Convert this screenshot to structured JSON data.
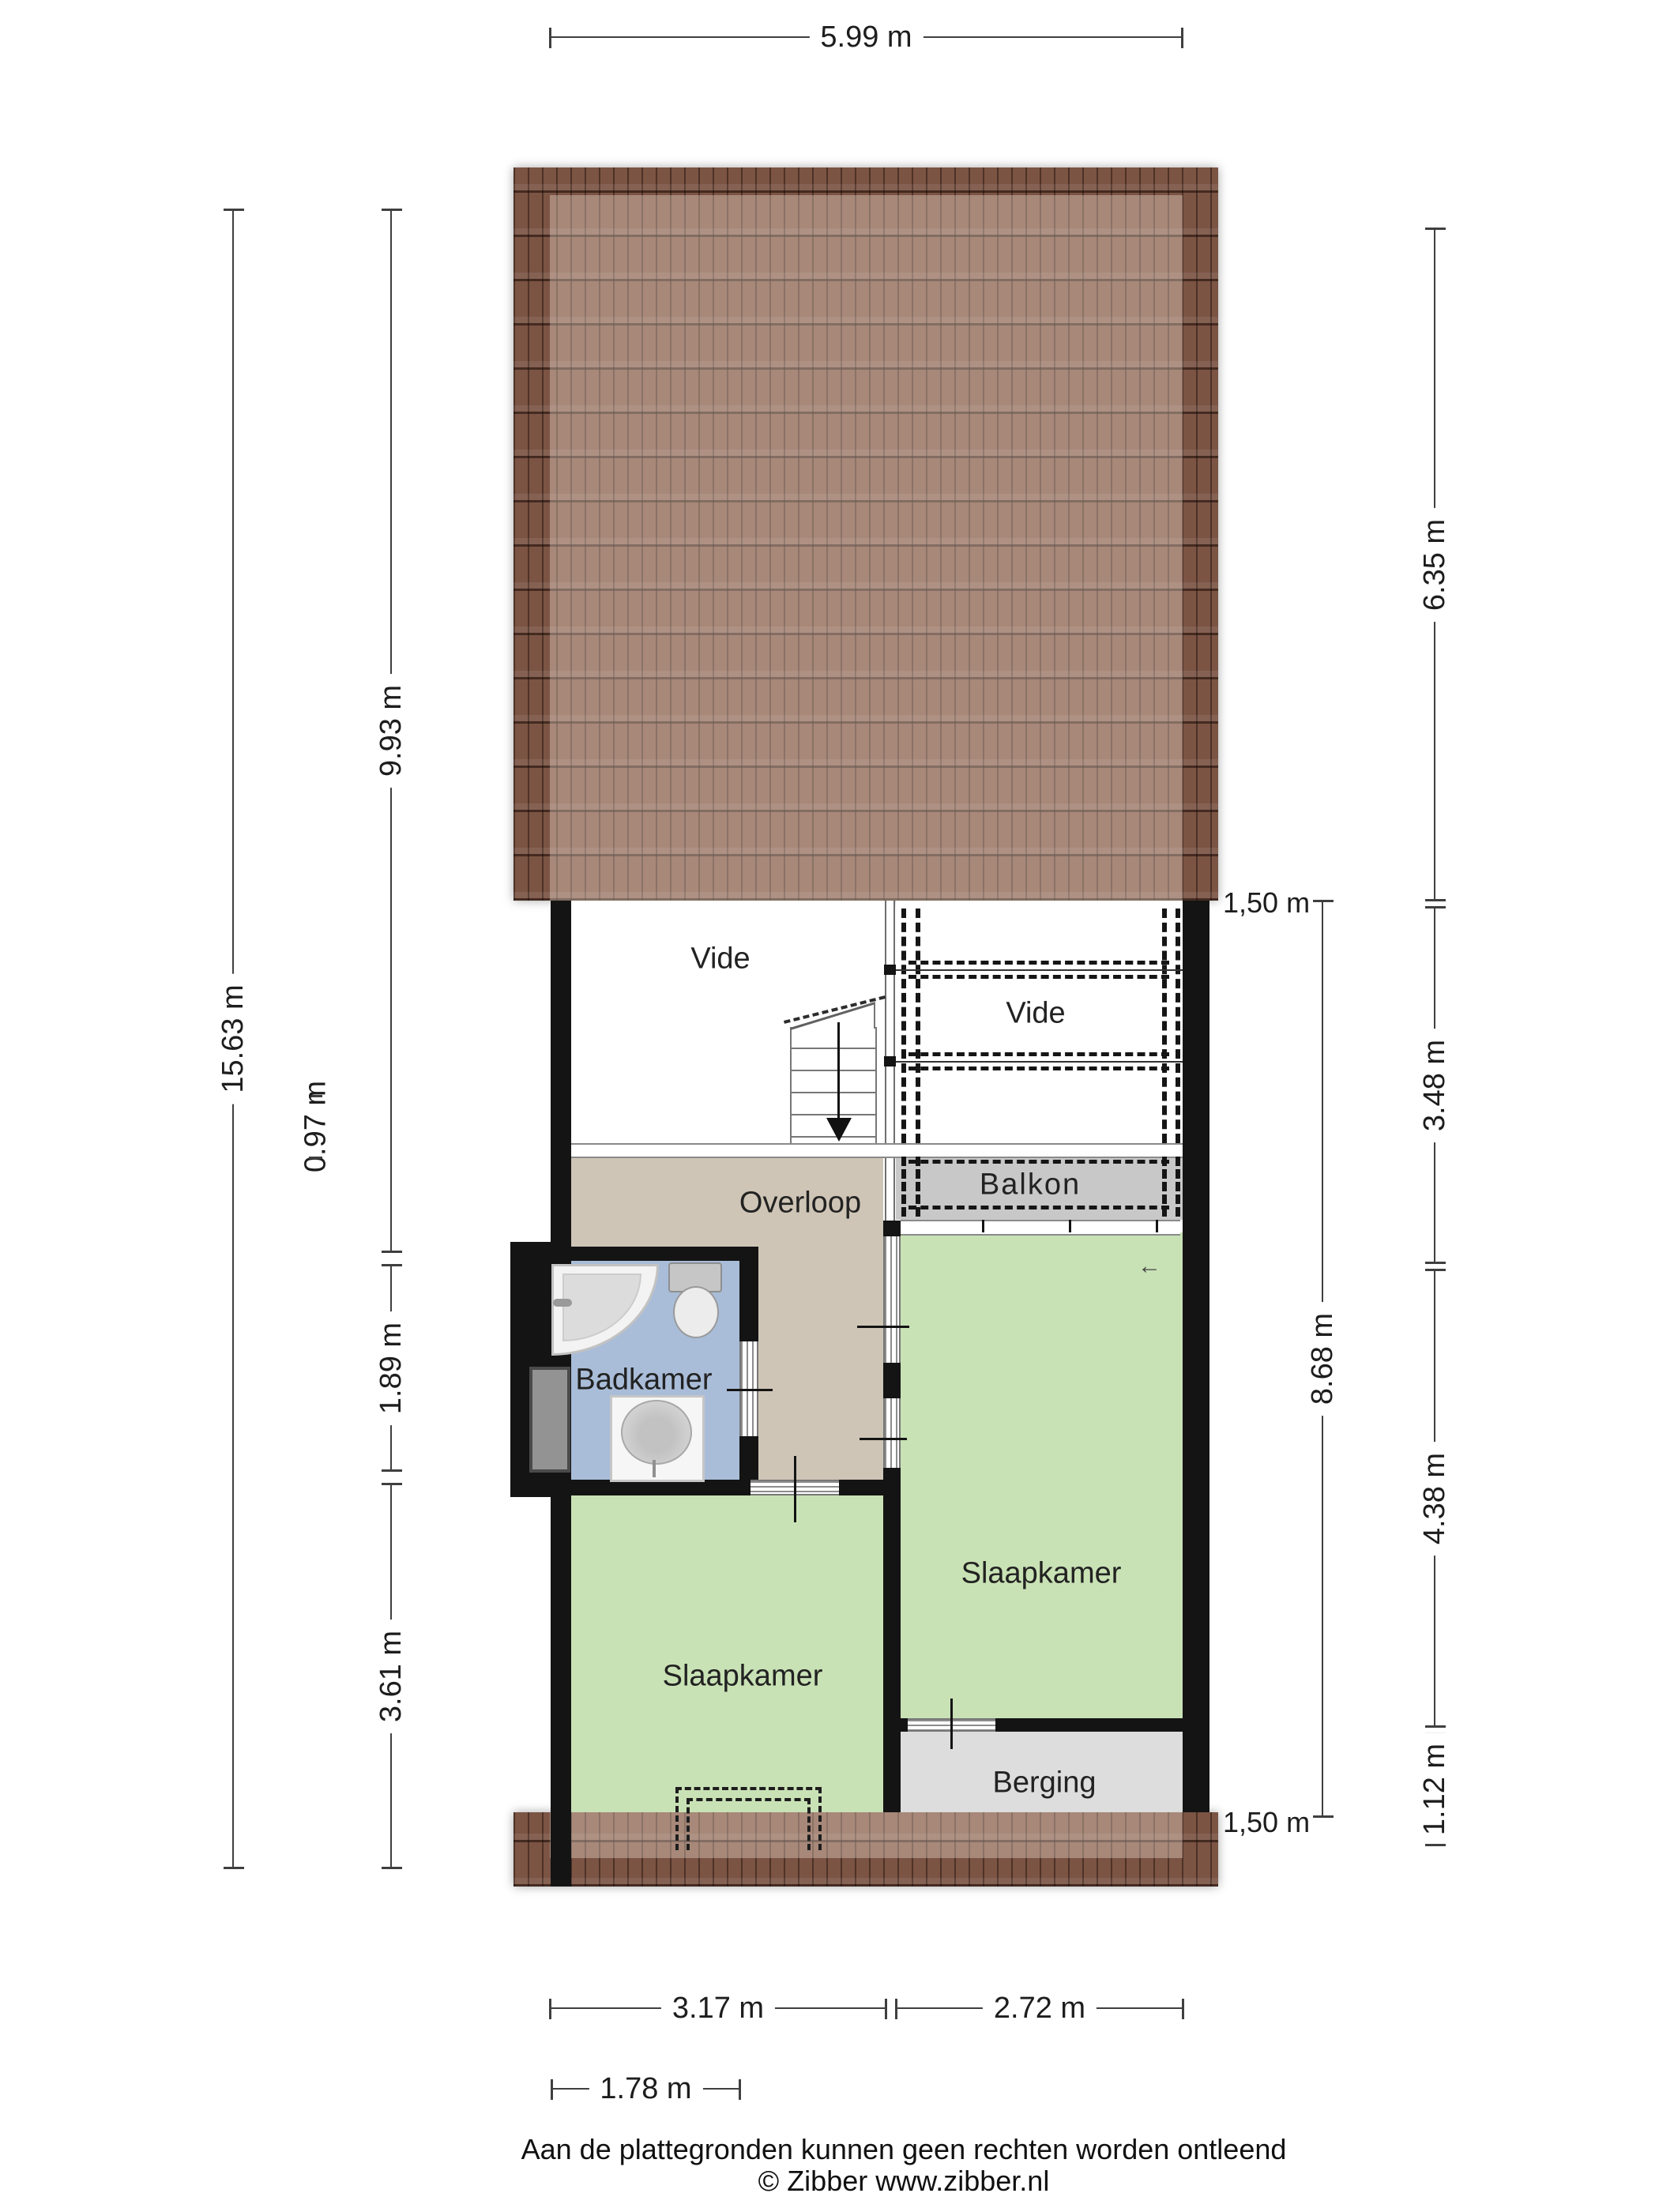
{
  "colors": {
    "wall": "#141414",
    "roof_tile": "#7b5444",
    "bedroom_green": "#c9e2b5",
    "bathroom_blue": "#a9bdd9",
    "hall_tan": "#cec5b6",
    "balcony_gray": "#c8c8c8",
    "storage_gray": "#dddddd",
    "dimension_line": "#3f3f3f"
  },
  "icons": {
    "window_arrow": "←"
  },
  "rooms": {
    "vide_left": {
      "label": "Vide"
    },
    "vide_right": {
      "label": "Vide"
    },
    "overloop": {
      "label": "Overloop"
    },
    "badkamer": {
      "label": "Badkamer"
    },
    "slaapkamer_right": {
      "label": "Slaapkamer"
    },
    "slaapkamer_left": {
      "label": "Slaapkamer"
    },
    "balkon": {
      "label": "Balkon"
    },
    "berging": {
      "label": "Berging"
    }
  },
  "dimensions": {
    "top_width": "5.99 m",
    "left_total": "15.63 m",
    "left_upper": "9.93 m",
    "left_small": "0.97 m",
    "left_bathroom": "1.89 m",
    "left_lower": "3.61 m",
    "right_roof_upper": "6.35 m",
    "right_roof_lower": "3.48 m",
    "right_inner_total": "8.68 m",
    "right_bedroom": "4.38 m",
    "right_storage": "1.12 m",
    "bottom_left": "3.17 m",
    "bottom_right": "2.72 m",
    "bottom_bathroom_width": "1.78 m",
    "roofline_top": "1,50 m",
    "roofline_bottom": "1,50 m"
  },
  "footer": {
    "disclaimer": "Aan de plattegronden kunnen geen rechten worden ontleend",
    "copyright": "© Zibber www.zibber.nl"
  }
}
